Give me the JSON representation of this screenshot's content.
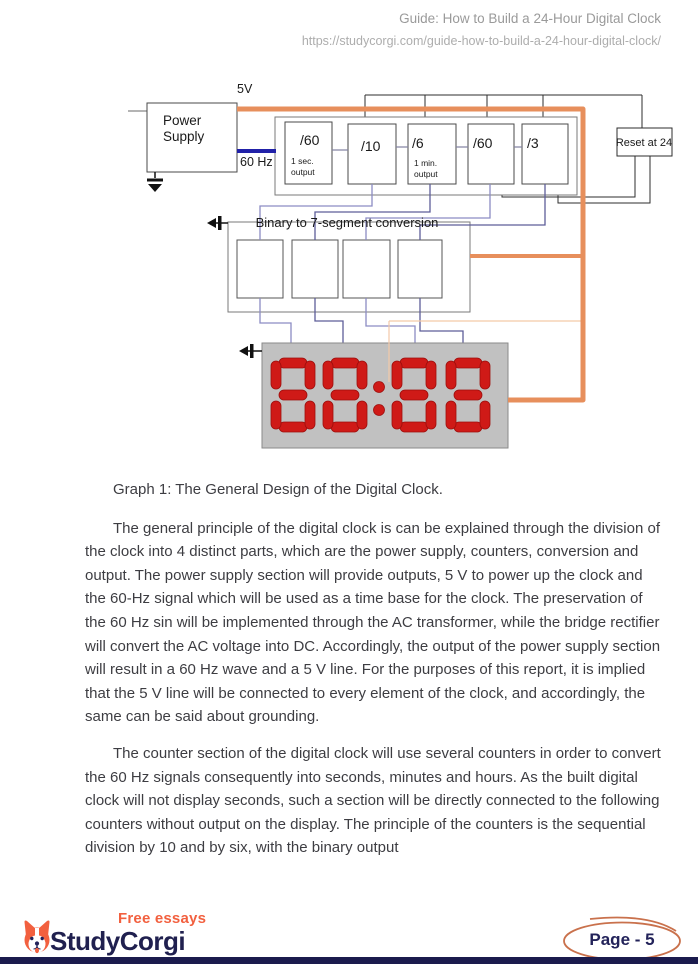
{
  "header": {
    "title": "Guide: How to Build a 24-Hour Digital Clock",
    "url": "https://studycorgi.com/guide-how-to-build-a-24-hour-digital-clock/"
  },
  "diagram": {
    "v5_label": "5V",
    "hz_label": "60 Hz",
    "power_supply_line1": "Power",
    "power_supply_line2": "Supply",
    "counters": [
      {
        "label": "/60",
        "sub1": "1 sec.",
        "sub2": "output"
      },
      {
        "label": "/10"
      },
      {
        "label": "/6",
        "sub1": "1 min.",
        "sub2": "output"
      },
      {
        "label": "/60"
      },
      {
        "label": "/3"
      }
    ],
    "reset_label": "Reset at 24",
    "conversion_label": "Binary to 7-segment conversion",
    "display_value": "88:88"
  },
  "caption": "Graph 1: The General Design of the Digital Clock.",
  "paragraphs": [
    "The general principle of the digital clock is can be explained through the division of the clock into 4 distinct parts, which are the power supply, counters, conversion and output. The power supply section will provide outputs, 5 V to power up the clock and the 60-Hz signal which will be used as a time base for the clock. The preservation of the 60 Hz sin will be implemented through the AC transformer, while the bridge rectifier will convert the AC voltage into DC. Accordingly, the output of the power supply section will result in a 60 Hz wave and a 5 V line. For the purposes of this report, it is implied that the 5 V line will be connected to every element of the clock, and accordingly, the same can be said about grounding.",
    "The counter section of the digital clock will use several counters in order to convert the 60 Hz signals consequently into seconds, minutes and hours. As the built digital clock will not display seconds, such a section will be directly connected to the following counters without output on the display. The principle of the counters is the sequential division by 10 and by six, with the binary output"
  ],
  "footer": {
    "free_essays": "Free essays",
    "brand": "StudyCorgi",
    "page_label": "Page - 5"
  },
  "colors": {
    "wire_5v_orange": "#e78f5c",
    "wire_60hz_blue": "#2121a8",
    "segment_red": "#cf1a17",
    "display_gray": "#c1c1c1",
    "brand_navy": "#20204f",
    "brand_orange": "#f2603f"
  }
}
